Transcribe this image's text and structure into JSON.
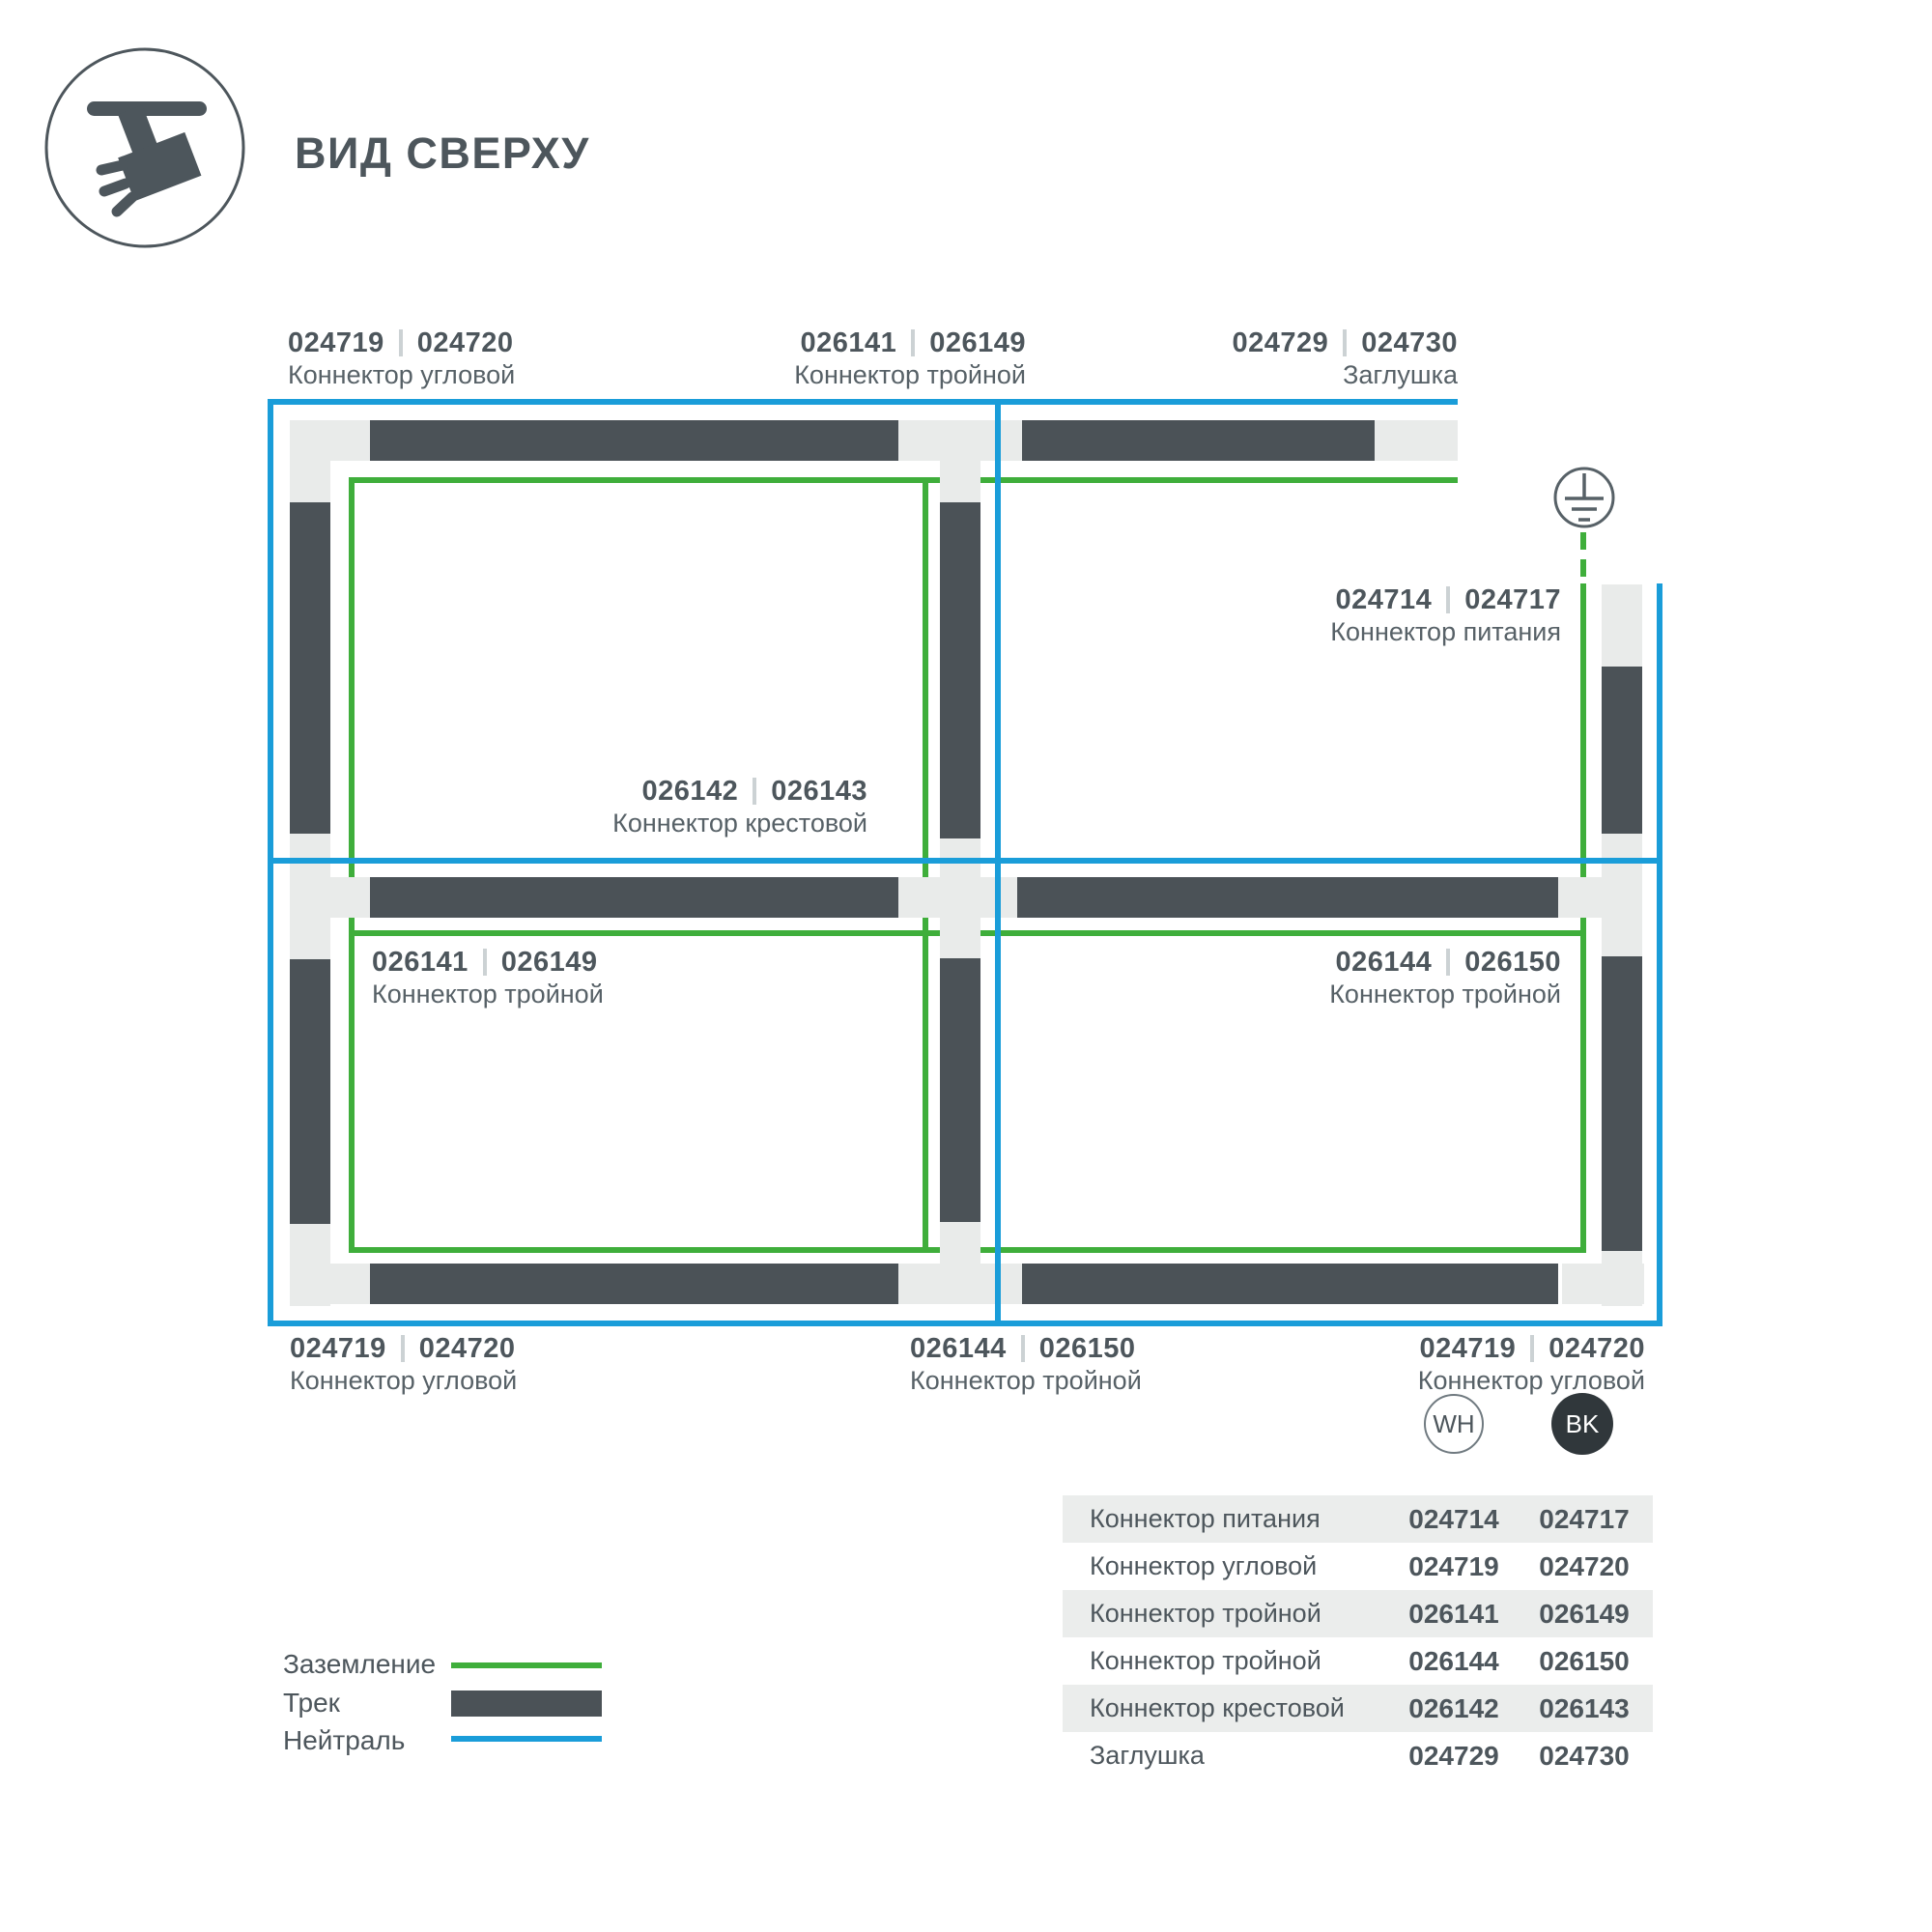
{
  "header": {
    "title": "ВИД СВЕРХУ",
    "icon": "track-spotlight-icon"
  },
  "colors": {
    "ground_green": "#3fae3b",
    "neutral_blue": "#1a9dd9",
    "track_dark": "#4b5257",
    "connector_light": "#e9ebea",
    "text_dark": "#4d565c",
    "table_stripe": "#ebedec",
    "bk_circle_fill": "#30373b"
  },
  "diagram": {
    "ground_symbol_icon": "earth-ground-icon",
    "labels": [
      {
        "wh": "024719",
        "bk": "024720",
        "name": "Коннектор угловой"
      },
      {
        "wh": "026141",
        "bk": "026149",
        "name": "Коннектор тройной"
      },
      {
        "wh": "024729",
        "bk": "024730",
        "name": "Заглушка"
      },
      {
        "wh": "024714",
        "bk": "024717",
        "name": "Коннектор питания"
      },
      {
        "wh": "026142",
        "bk": "026143",
        "name": "Коннектор крестовой"
      },
      {
        "wh": "026141",
        "bk": "026149",
        "name": "Коннектор тройной"
      },
      {
        "wh": "026144",
        "bk": "026150",
        "name": "Коннектор тройной"
      },
      {
        "wh": "024719",
        "bk": "024720",
        "name": "Коннектор угловой"
      },
      {
        "wh": "026144",
        "bk": "026150",
        "name": "Коннектор тройной"
      },
      {
        "wh": "024719",
        "bk": "024720",
        "name": "Коннектор угловой"
      }
    ]
  },
  "legend": {
    "items": [
      {
        "label": "Заземление",
        "swatch": "ground-line"
      },
      {
        "label": "Трек",
        "swatch": "track-bar"
      },
      {
        "label": "Нейтраль",
        "swatch": "neutral-line"
      }
    ]
  },
  "table": {
    "col_wh": "WH",
    "col_bk": "BK",
    "rows": [
      {
        "name": "Коннектор питания",
        "wh": "024714",
        "bk": "024717"
      },
      {
        "name": "Коннектор угловой",
        "wh": "024719",
        "bk": "024720"
      },
      {
        "name": "Коннектор тройной",
        "wh": "026141",
        "bk": "026149"
      },
      {
        "name": "Коннектор тройной",
        "wh": "026144",
        "bk": "026150"
      },
      {
        "name": "Коннектор крестовой",
        "wh": "026142",
        "bk": "026143"
      },
      {
        "name": "Заглушка",
        "wh": "024729",
        "bk": "024730"
      }
    ]
  }
}
